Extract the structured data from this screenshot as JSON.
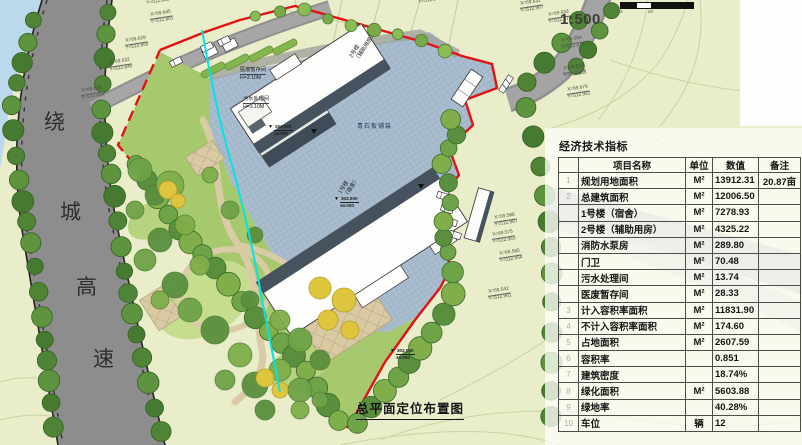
{
  "drawing": {
    "title": "总平面定位布置图",
    "scale_text": "1:500",
    "scale_bar_labels": [
      "0",
      "20"
    ]
  },
  "highway_label": {
    "chars": [
      "绕",
      "城",
      "高",
      "速"
    ]
  },
  "plan_labels": {
    "paving": "青石板铺装",
    "building1_line1": "1号楼",
    "building1_line2": "（宿舍）",
    "building2_line1": "2号楼",
    "building2_line2": "（辅助用房）",
    "room1_line1": "医废暂存间",
    "room1_line2": "H=3.10M",
    "room2_line1": "污水处理间",
    "room2_line2": "H=3.10M",
    "elev_top": "302.900",
    "elev_bottom": "±0.000"
  },
  "elevation_markers": [
    {
      "x": 268,
      "y": 124
    },
    {
      "x": 334,
      "y": 196
    },
    {
      "x": 390,
      "y": 348
    }
  ],
  "coordinate_callouts": [
    {
      "x": 146,
      "y": 1,
      "lines": [
        "Y=512.885"
      ]
    },
    {
      "x": 149,
      "y": 13,
      "lines": [
        "X=69.645",
        "Y=512.861"
      ]
    },
    {
      "x": 124,
      "y": 39,
      "lines": [
        "X=69.629",
        "Y=512.850"
      ]
    },
    {
      "x": 108,
      "y": 61,
      "lines": [
        "X=69.622",
        "Y=512.840"
      ]
    },
    {
      "x": 80,
      "y": 89,
      "lines": [
        "X=69.608",
        "Y=512.834"
      ]
    },
    {
      "x": 418,
      "y": 0,
      "lines": [
        "Y=512.883"
      ]
    },
    {
      "x": 519,
      "y": 2,
      "lines": [
        "X=69.632",
        "Y=512.967"
      ]
    },
    {
      "x": 547,
      "y": 13,
      "lines": [
        "X=69.633",
        "Y=512.978"
      ]
    },
    {
      "x": 560,
      "y": 39,
      "lines": [
        "X=69.654",
        "Y=512.876"
      ]
    },
    {
      "x": 562,
      "y": 67,
      "lines": [
        "X=69.819",
        "Y=512.936"
      ]
    },
    {
      "x": 566,
      "y": 88,
      "lines": [
        "X=69.679",
        "Y=512.981"
      ]
    },
    {
      "x": 493,
      "y": 216,
      "lines": [
        "X=69.588",
        "Y=512.987"
      ]
    },
    {
      "x": 491,
      "y": 233,
      "lines": [
        "X=69.575",
        "Y=512.963"
      ]
    },
    {
      "x": 498,
      "y": 252,
      "lines": [
        "X=69.585",
        "Y=512.954"
      ]
    },
    {
      "x": 487,
      "y": 290,
      "lines": [
        "X=69.542",
        "Y=512.961"
      ]
    }
  ],
  "table": {
    "title": "经济技术指标",
    "headers": {
      "num": "",
      "name": "项目名称",
      "unit": "单位",
      "value": "数值",
      "remark": "备注"
    },
    "rows": [
      {
        "num": "1",
        "name": "规划用地面积",
        "unit": "M²",
        "value": "13912.31",
        "remark": "20.87亩"
      },
      {
        "num": "2",
        "name": "总建筑面积",
        "unit": "M²",
        "value": "12006.50",
        "remark": ""
      },
      {
        "num": "",
        "name": "1号楼（宿舍）",
        "unit": "M²",
        "value": "7278.93",
        "remark": ""
      },
      {
        "num": "",
        "name": "2号楼（辅助用房）",
        "unit": "M²",
        "value": "4325.22",
        "remark": ""
      },
      {
        "num": "",
        "name": "消防水泵房",
        "unit": "M²",
        "value": "289.80",
        "remark": ""
      },
      {
        "num": "",
        "name": "门卫",
        "unit": "M²",
        "value": "70.48",
        "remark": ""
      },
      {
        "num": "",
        "name": "污水处理间",
        "unit": "M²",
        "value": "13.74",
        "remark": ""
      },
      {
        "num": "",
        "name": "医废暂存间",
        "unit": "M²",
        "value": "28.33",
        "remark": ""
      },
      {
        "num": "3",
        "name": "计入容积率面积",
        "unit": "M²",
        "value": "11831.90",
        "remark": ""
      },
      {
        "num": "4",
        "name": "不计入容积率面积",
        "unit": "M²",
        "value": "174.60",
        "remark": ""
      },
      {
        "num": "5",
        "name": "占地面积",
        "unit": "M²",
        "value": "2607.59",
        "remark": ""
      },
      {
        "num": "6",
        "name": "容积率",
        "unit": "",
        "value": "0.851",
        "remark": ""
      },
      {
        "num": "7",
        "name": "建筑密度",
        "unit": "",
        "value": "18.74%",
        "remark": ""
      },
      {
        "num": "8",
        "name": "绿化面积",
        "unit": "M²",
        "value": "5603.88",
        "remark": ""
      },
      {
        "num": "9",
        "name": "绿地率",
        "unit": "",
        "value": "40.28%",
        "remark": ""
      },
      {
        "num": "10",
        "name": "车位",
        "unit": "辆",
        "value": "12",
        "remark": ""
      }
    ]
  }
}
